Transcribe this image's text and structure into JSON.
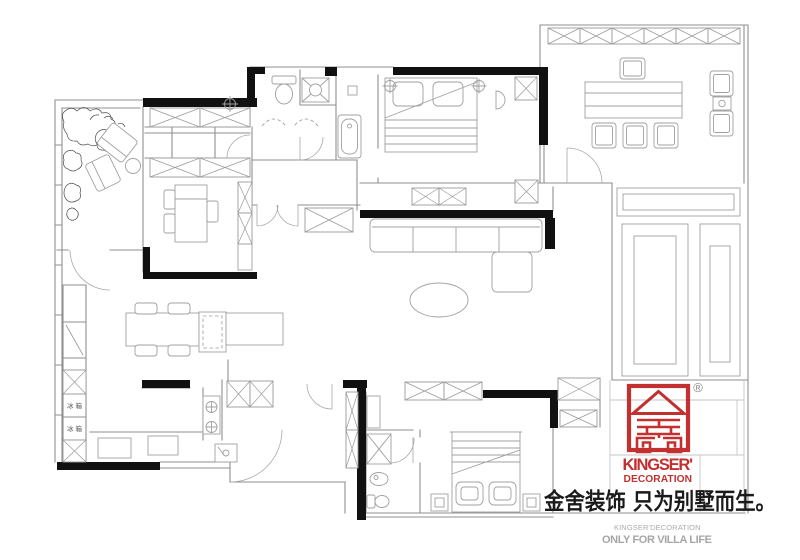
{
  "branding": {
    "logo": {
      "registered_mark": "®",
      "name_line1": "KINGSER'",
      "name_line2": "DECORATION"
    },
    "slogan_cn": "金舍装饰 只为别墅而生。",
    "subtext_line1": "KINGSER'DECORATION",
    "subtext_line2": "ONLY FOR VILLA LIFE"
  },
  "floor_plan": {
    "labels": {
      "fridge_upper": "冰箱",
      "fridge_lower": "冰箱"
    }
  },
  "colors": {
    "brand_red": "#C2302F",
    "wall_black": "#111111",
    "line_gray": "#8F8F8F",
    "muted_text": "#A9A9A9"
  }
}
